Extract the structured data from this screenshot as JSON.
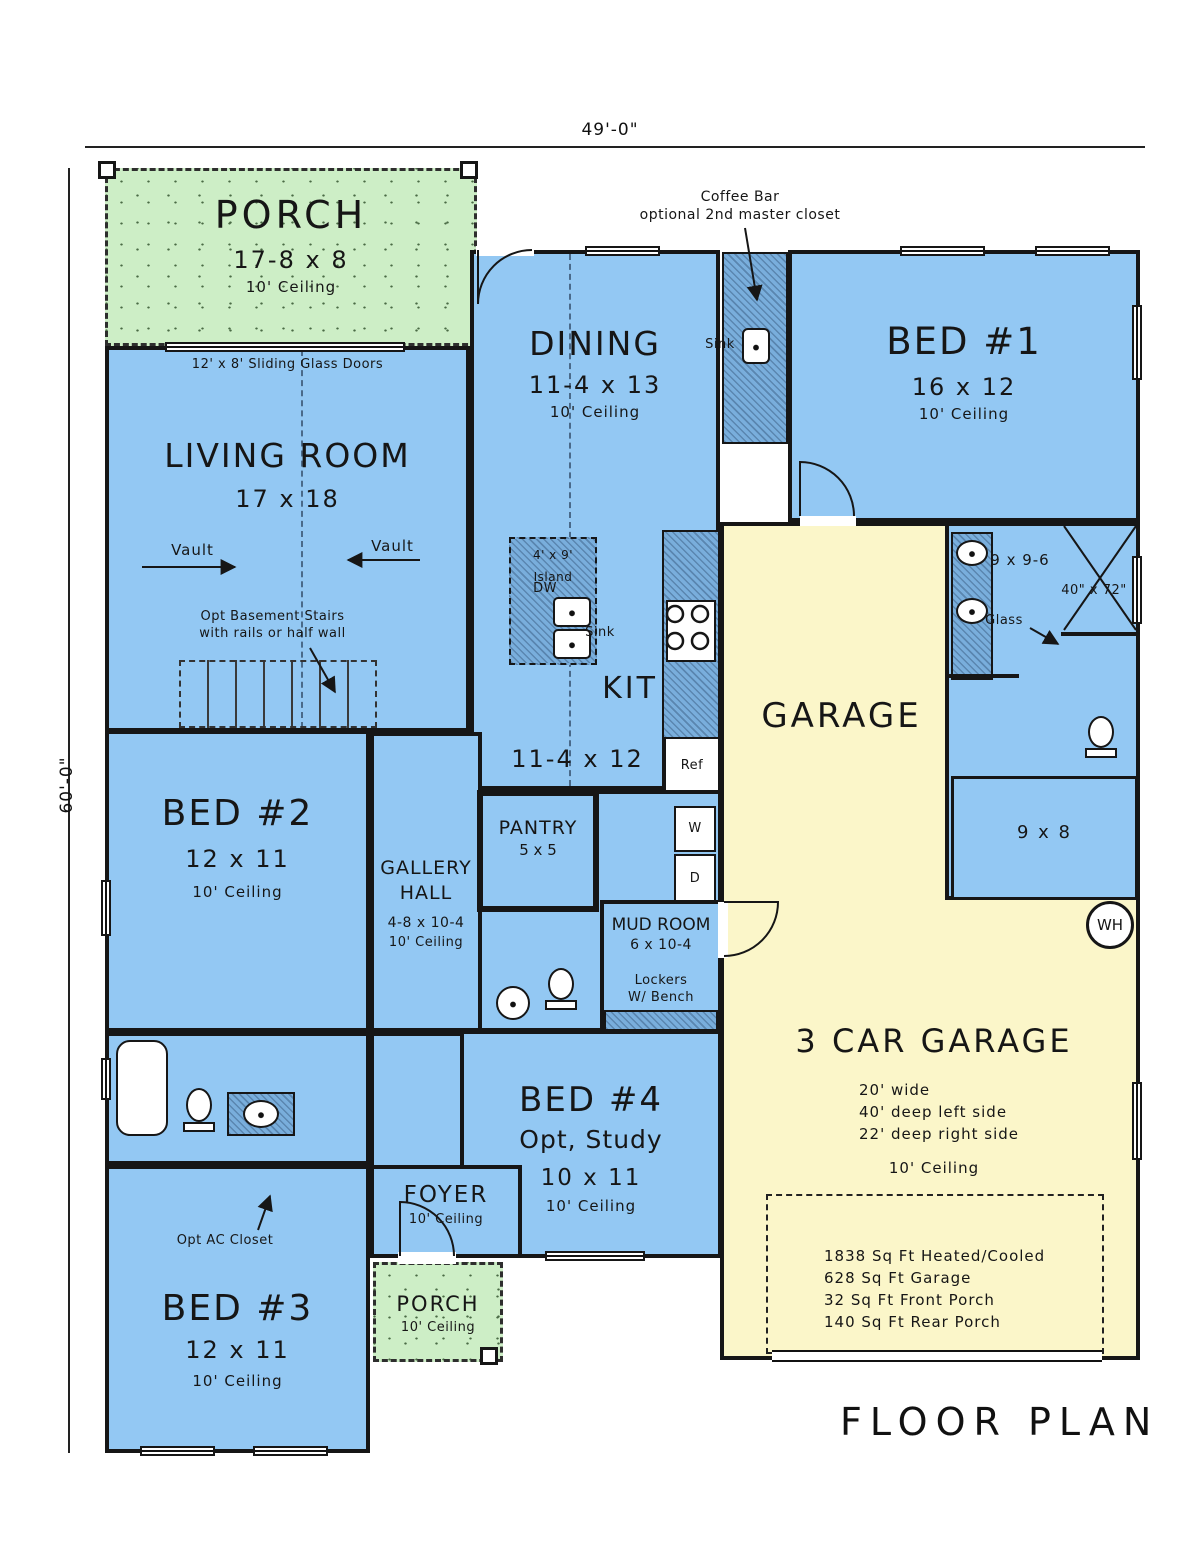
{
  "title": "FLOOR PLAN",
  "dimensions": {
    "width_label": "49'-0\"",
    "height_label": "60'-0\""
  },
  "colors": {
    "room_blue": "#93C8F3",
    "wall_hatch": "#79AEDC",
    "porch_green": "#CDEEC6",
    "garage_yellow": "#FBF6C9",
    "line": "#161616"
  },
  "rooms": {
    "porch_top": {
      "name": "PORCH",
      "size": "17-8 x 8",
      "ceiling": "10' Ceiling"
    },
    "living": {
      "name": "LIVING ROOM",
      "size": "17 x 18"
    },
    "dining": {
      "name": "DINING",
      "size": "11-4 x 13",
      "ceiling": "10' Ceiling"
    },
    "kitchen": {
      "name": "KIT",
      "size": "11-4 x 12"
    },
    "bed1": {
      "name": "BED #1",
      "size": "16 x 12",
      "ceiling": "10' Ceiling"
    },
    "bed2": {
      "name": "BED #2",
      "size": "12 x 11",
      "ceiling": "10' Ceiling"
    },
    "bed3": {
      "name": "BED #3",
      "size": "12 x 11",
      "ceiling": "10' Ceiling"
    },
    "bed4": {
      "name": "BED #4",
      "alt": "Opt, Study",
      "size": "10 x 11",
      "ceiling": "10' Ceiling"
    },
    "gallery_hall": {
      "name_line1": "GALLERY",
      "name_line2": "HALL",
      "size": "4-8 x 10-4",
      "ceiling": "10' Ceiling"
    },
    "pantry": {
      "name": "PANTRY",
      "size": "5 x 5"
    },
    "mud_room": {
      "name": "MUD ROOM",
      "size": "6 x 10-4",
      "lockers_line1": "Lockers",
      "lockers_line2": "W/ Bench"
    },
    "foyer": {
      "name": "FOYER",
      "ceiling": "10' Ceiling"
    },
    "porch_bottom": {
      "name": "PORCH",
      "ceiling": "10' Ceiling"
    },
    "garage": {
      "name": "GARAGE",
      "title": "3 CAR GARAGE",
      "note_width": "20' wide",
      "note_left": "40' deep left side",
      "note_right": "22' deep right side",
      "ceiling": "10' Ceiling"
    },
    "master_bath": {
      "size": "9 x 9-6",
      "shower": "40\" x 72\"",
      "glass": "Glass",
      "closet": "9 x 8"
    }
  },
  "annotations": {
    "coffee_line1": "Coffee Bar",
    "coffee_line2": "optional 2nd master closet",
    "coffee_sink": "Sink",
    "sliding_doors": "12' x 8' Sliding Glass Doors",
    "vault": "Vault",
    "stairs_line1": "Opt Basement Stairs",
    "stairs_line2": "with rails or half wall",
    "island_line1": "4' x 9'",
    "island_line2": "Island",
    "dishwasher": "DW",
    "kitchen_sink": "Sink",
    "fridge": "Ref",
    "washer": "W",
    "dryer": "D",
    "ac_closet": "Opt AC Closet",
    "water_heater": "WH"
  },
  "area_summary": {
    "line1": "1838 Sq Ft Heated/Cooled",
    "line2": "628 Sq Ft Garage",
    "line3": "32 Sq Ft Front Porch",
    "line4": "140 Sq Ft Rear Porch"
  }
}
